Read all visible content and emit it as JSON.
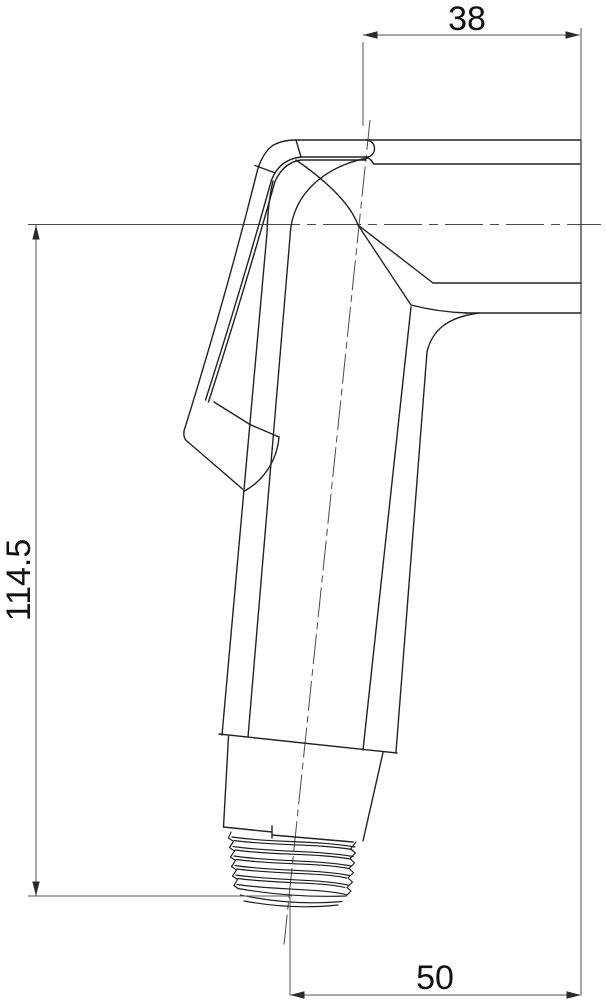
{
  "drawing": {
    "subject": "handheld-sprayer-side-view",
    "dimensions": {
      "width_top": "38",
      "height_left": "114.5",
      "width_bottom": "50"
    },
    "colors": {
      "background": "#ffffff",
      "object_line": "#222222",
      "dimension_line": "#555555",
      "text": "#111111"
    }
  }
}
